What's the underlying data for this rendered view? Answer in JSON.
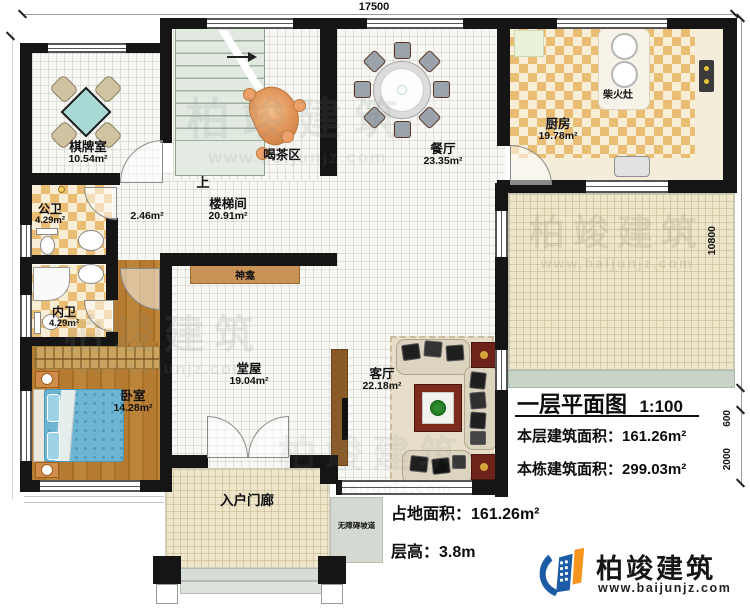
{
  "dims": {
    "top": "17500",
    "right_main": "10800",
    "right_step": "600",
    "right_porch": "2000"
  },
  "rooms": {
    "chess": {
      "name": "棋牌室",
      "area": "10.54m²"
    },
    "public_bath": {
      "name": "公卫",
      "area": "4.29m²"
    },
    "inner_bath": {
      "name": "内卫",
      "area": "4.29m²"
    },
    "bedroom": {
      "name": "卧室",
      "area": "14.28m²"
    },
    "stairwell": {
      "name": "楼梯间",
      "area": "20.91m²"
    },
    "corridor": {
      "area": "2.46m²"
    },
    "tea": {
      "name": "喝茶区"
    },
    "dining": {
      "name": "餐厅",
      "area": "23.35m²"
    },
    "kitchen": {
      "name": "厨房",
      "area": "19.78m²"
    },
    "hall": {
      "name": "堂屋",
      "area": "19.04m²"
    },
    "living": {
      "name": "客厅",
      "area": "22.18m²"
    },
    "porch": {
      "name": "入户门廊"
    }
  },
  "features": {
    "up": "上",
    "shrine": "神龛",
    "stove": "柴火灶",
    "ramp": "无障碍坡道"
  },
  "title": {
    "heading": "一层平面图",
    "scale": "1:100",
    "l1_label": "本层建筑面积：",
    "l1_value": "161.26m²",
    "l2_label": "本栋建筑面积：",
    "l2_value": "299.03m²",
    "l3_label": "占地面积：",
    "l3_value": "161.26m²",
    "l4_label": "层高：",
    "l4_value": "3.8m"
  },
  "brand": {
    "name": "柏竣建筑",
    "url": "www.baijunjz.com"
  },
  "watermark": {
    "text": "柏竣建筑",
    "url": "www.baijunjz.com"
  },
  "colors": {
    "wall": "#151515",
    "brand_blue": "#1b5ca5",
    "brand_orange": "#f7941e",
    "checker_tile": "#e9bd74",
    "wood_floor": "#b0762f",
    "bed_blue": "#6db6d3",
    "chess_table_teal": "#a9d9d5",
    "tea_table_orange": "#df9357",
    "patio_beige": "#eee6cb",
    "stair_green": "#e1e9e1"
  }
}
